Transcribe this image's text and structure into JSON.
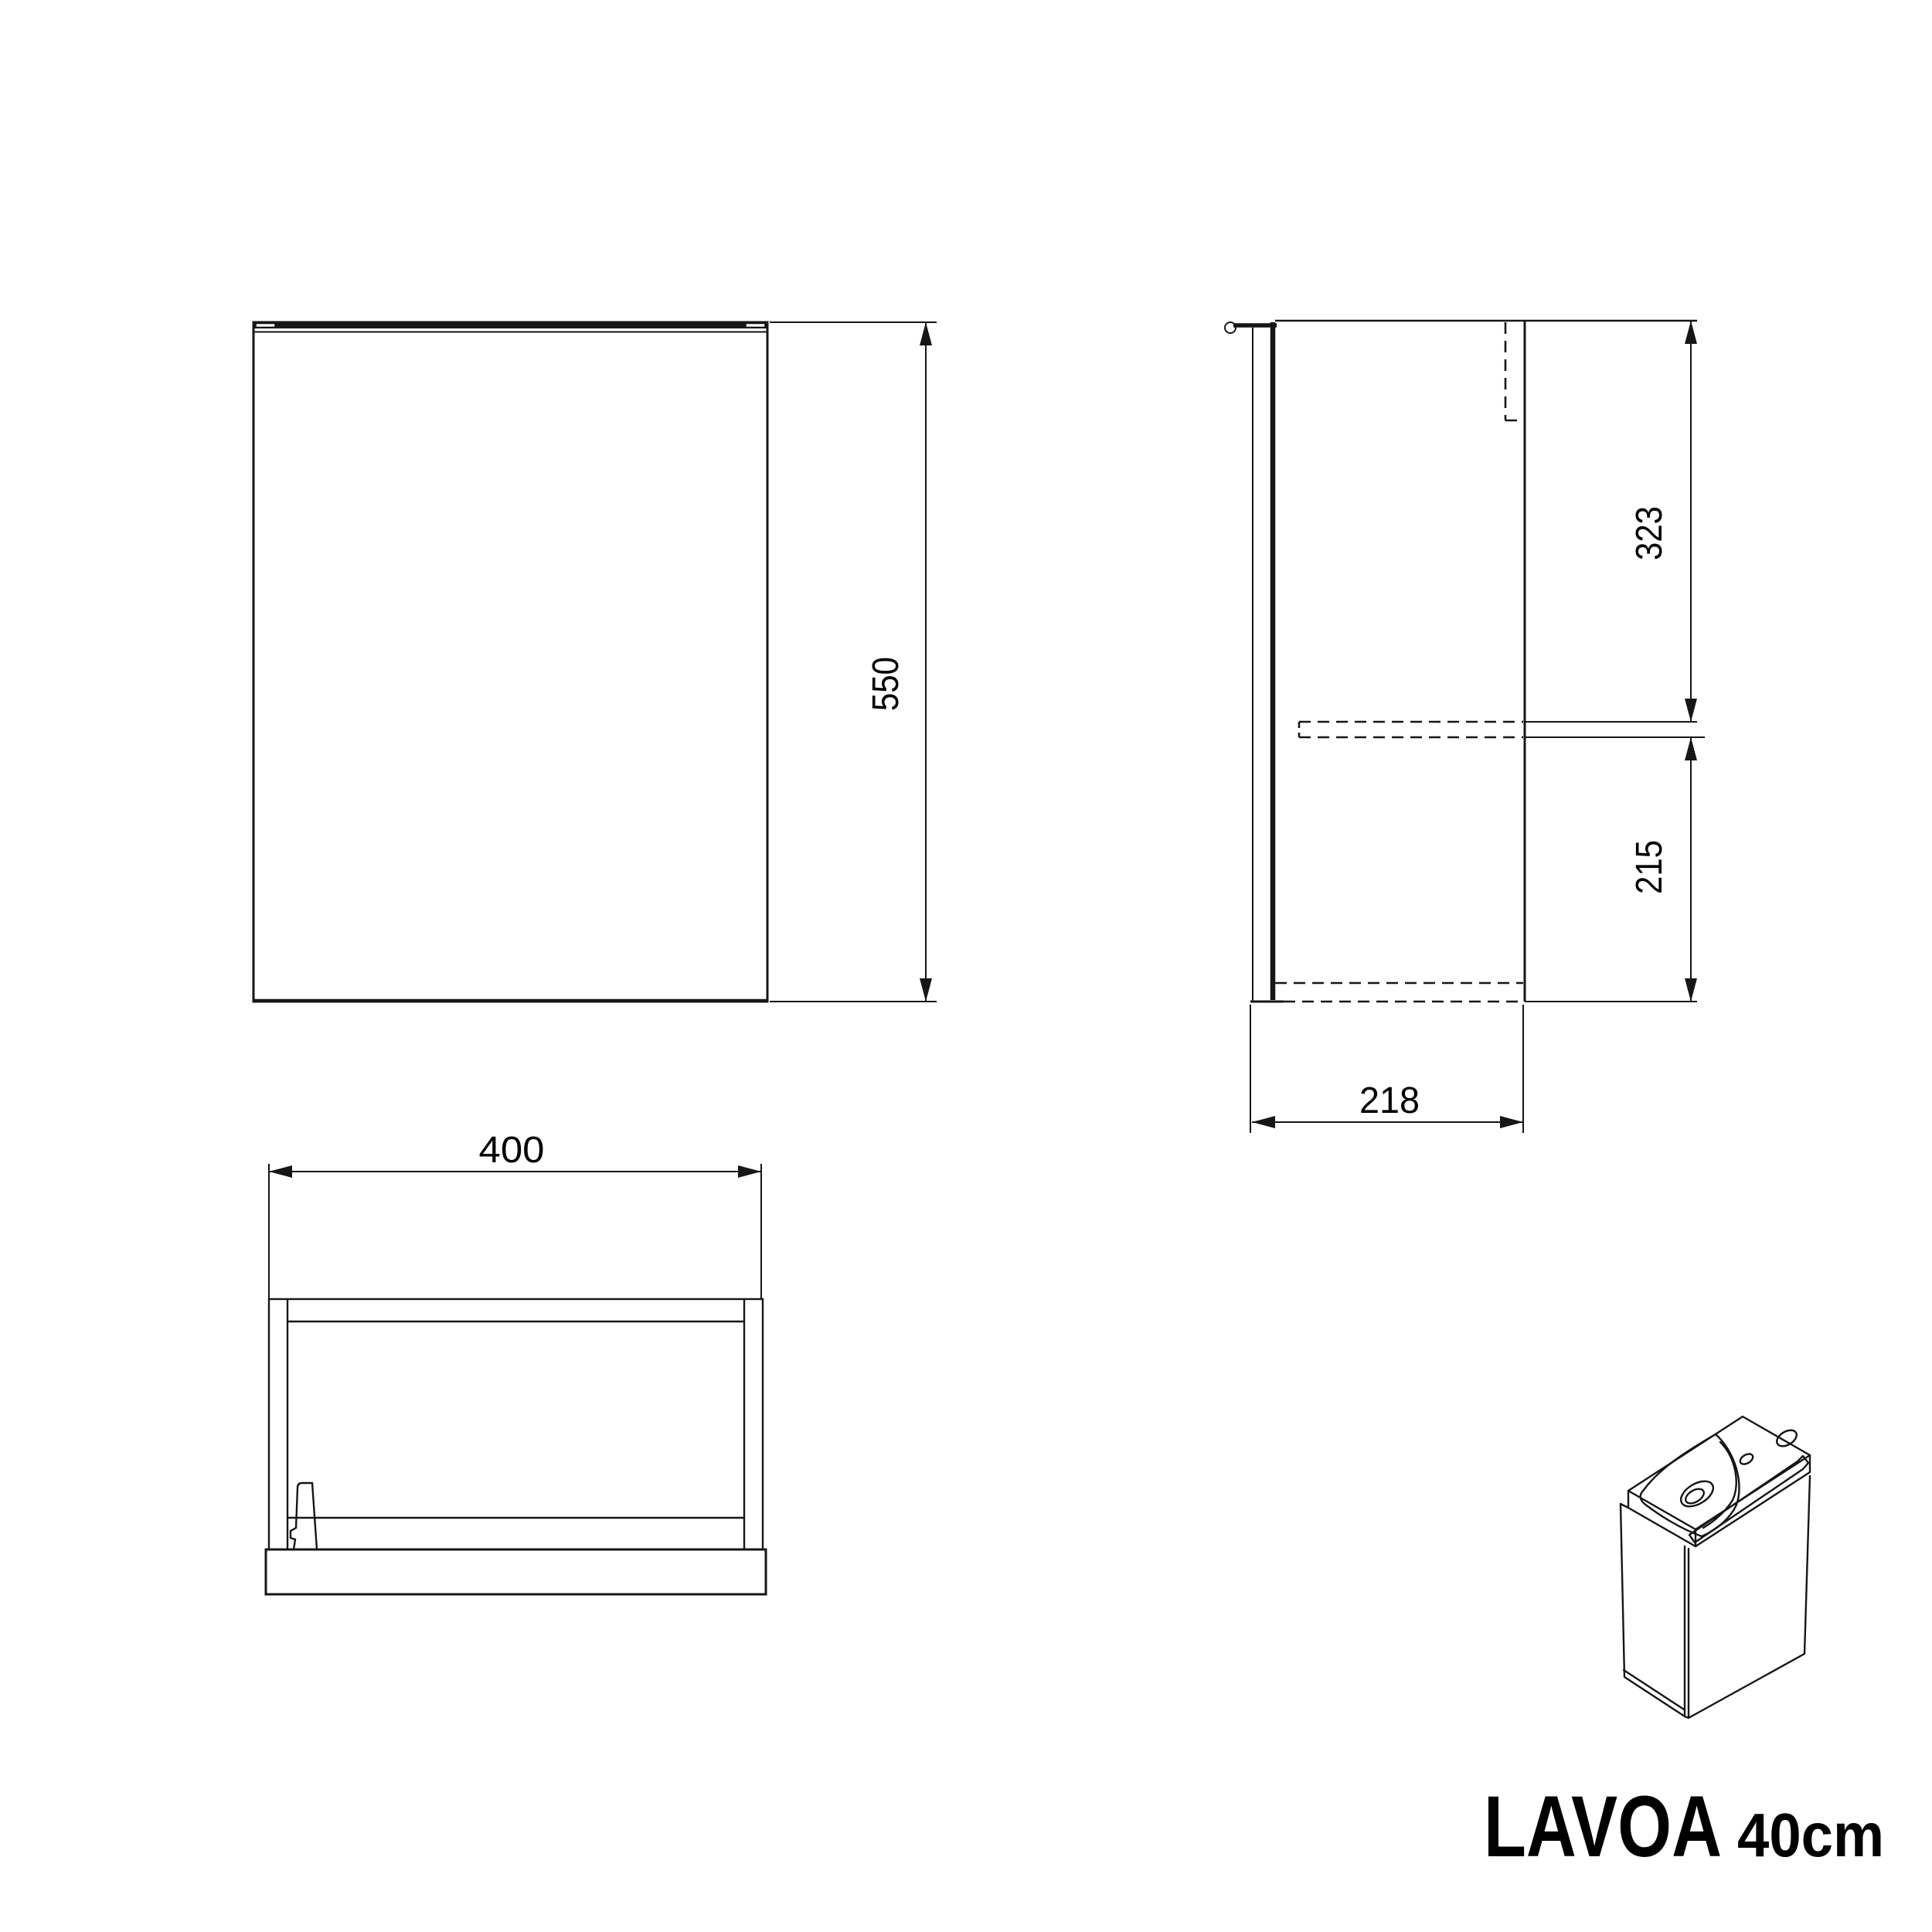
{
  "colors": {
    "background": "#ffffff",
    "line": "#161616",
    "text": "#000000"
  },
  "dimensions": {
    "front_height": "550",
    "side_upper_section": "323",
    "side_lower_section": "215",
    "side_depth": "218",
    "front_width": "400"
  },
  "title": {
    "product": "LAVOA",
    "size": "40cm"
  }
}
